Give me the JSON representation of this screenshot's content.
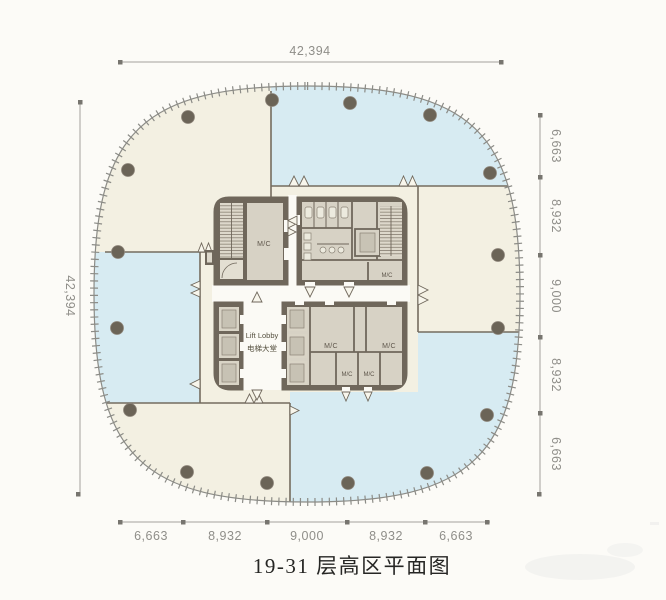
{
  "title": "19-31 层高区平面图",
  "dimensions": {
    "top": "42,394",
    "left": "42,394",
    "right": [
      "6,663",
      "8,932",
      "9,000",
      "8,932",
      "6,663"
    ],
    "bottom": [
      "6,663",
      "8,932",
      "9,000",
      "8,932",
      "6,663"
    ]
  },
  "core_labels": {
    "machine_room": "M/C",
    "lift_lobby_en": "Lift Lobby",
    "lift_lobby_zh": "电梯大堂"
  },
  "colors": {
    "floor_cream": "#f3f0e2",
    "zone_blue": "#d7ebf2",
    "core_wall": "#6f675b",
    "room_fill": "#d7d2c5",
    "column": "#6b6457",
    "dimension_gray": "#8f8e89",
    "outline_gray": "#8c8c87",
    "title_color": "#262624"
  }
}
